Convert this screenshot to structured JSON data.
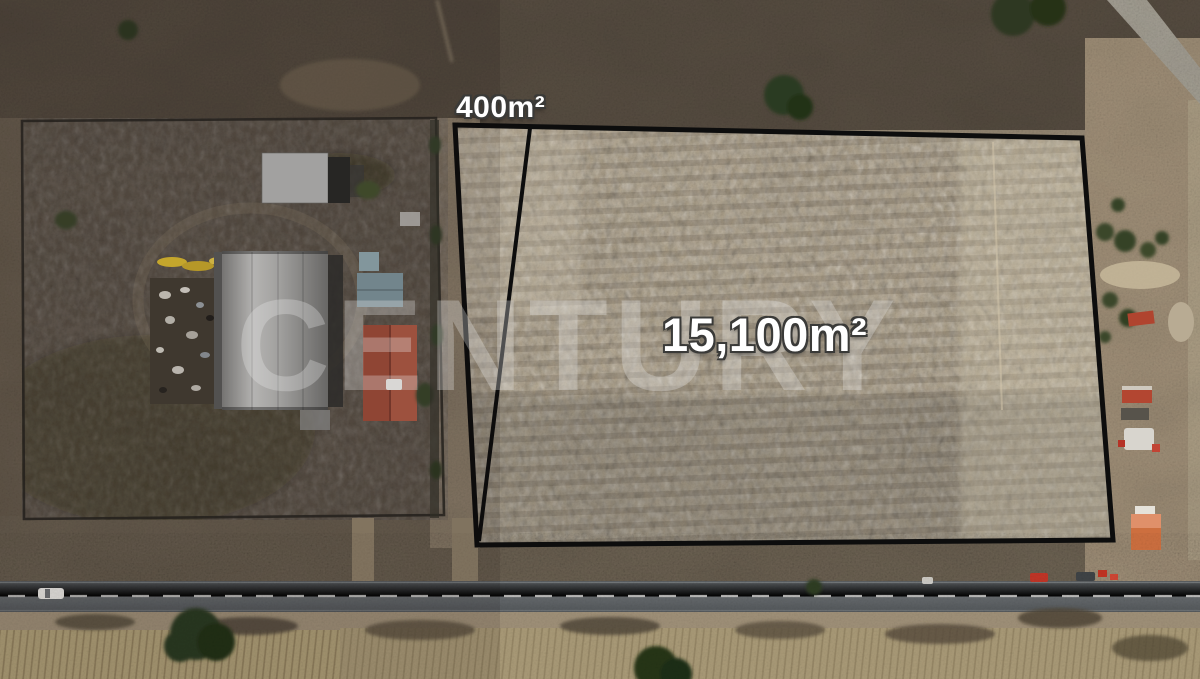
{
  "scene": {
    "type": "aerial-drone-photo",
    "subject": "land parcels beside highway with neighboring warehouse property"
  },
  "watermark": {
    "text": "CENTURY"
  },
  "labels": {
    "small_lot": "400m²",
    "large_lot": "15,100m²"
  },
  "parcel": {
    "outline_points": "455,125 1082,138 1113,540 477,545",
    "outline_color": "#0d0d0d",
    "outline_width": "5",
    "divider": {
      "x1": "530",
      "y1": "128",
      "x2": "479",
      "y2": "541"
    }
  },
  "palette": {
    "field_light": "#b6a88f",
    "scrub_dark": "#574d41",
    "road_asphalt": "#5b5f62",
    "warehouse_roof": "#b2b2b0",
    "tile_roof": "#a14f3c",
    "label_text": "#ffffff",
    "outline": "#0d0d0d"
  }
}
